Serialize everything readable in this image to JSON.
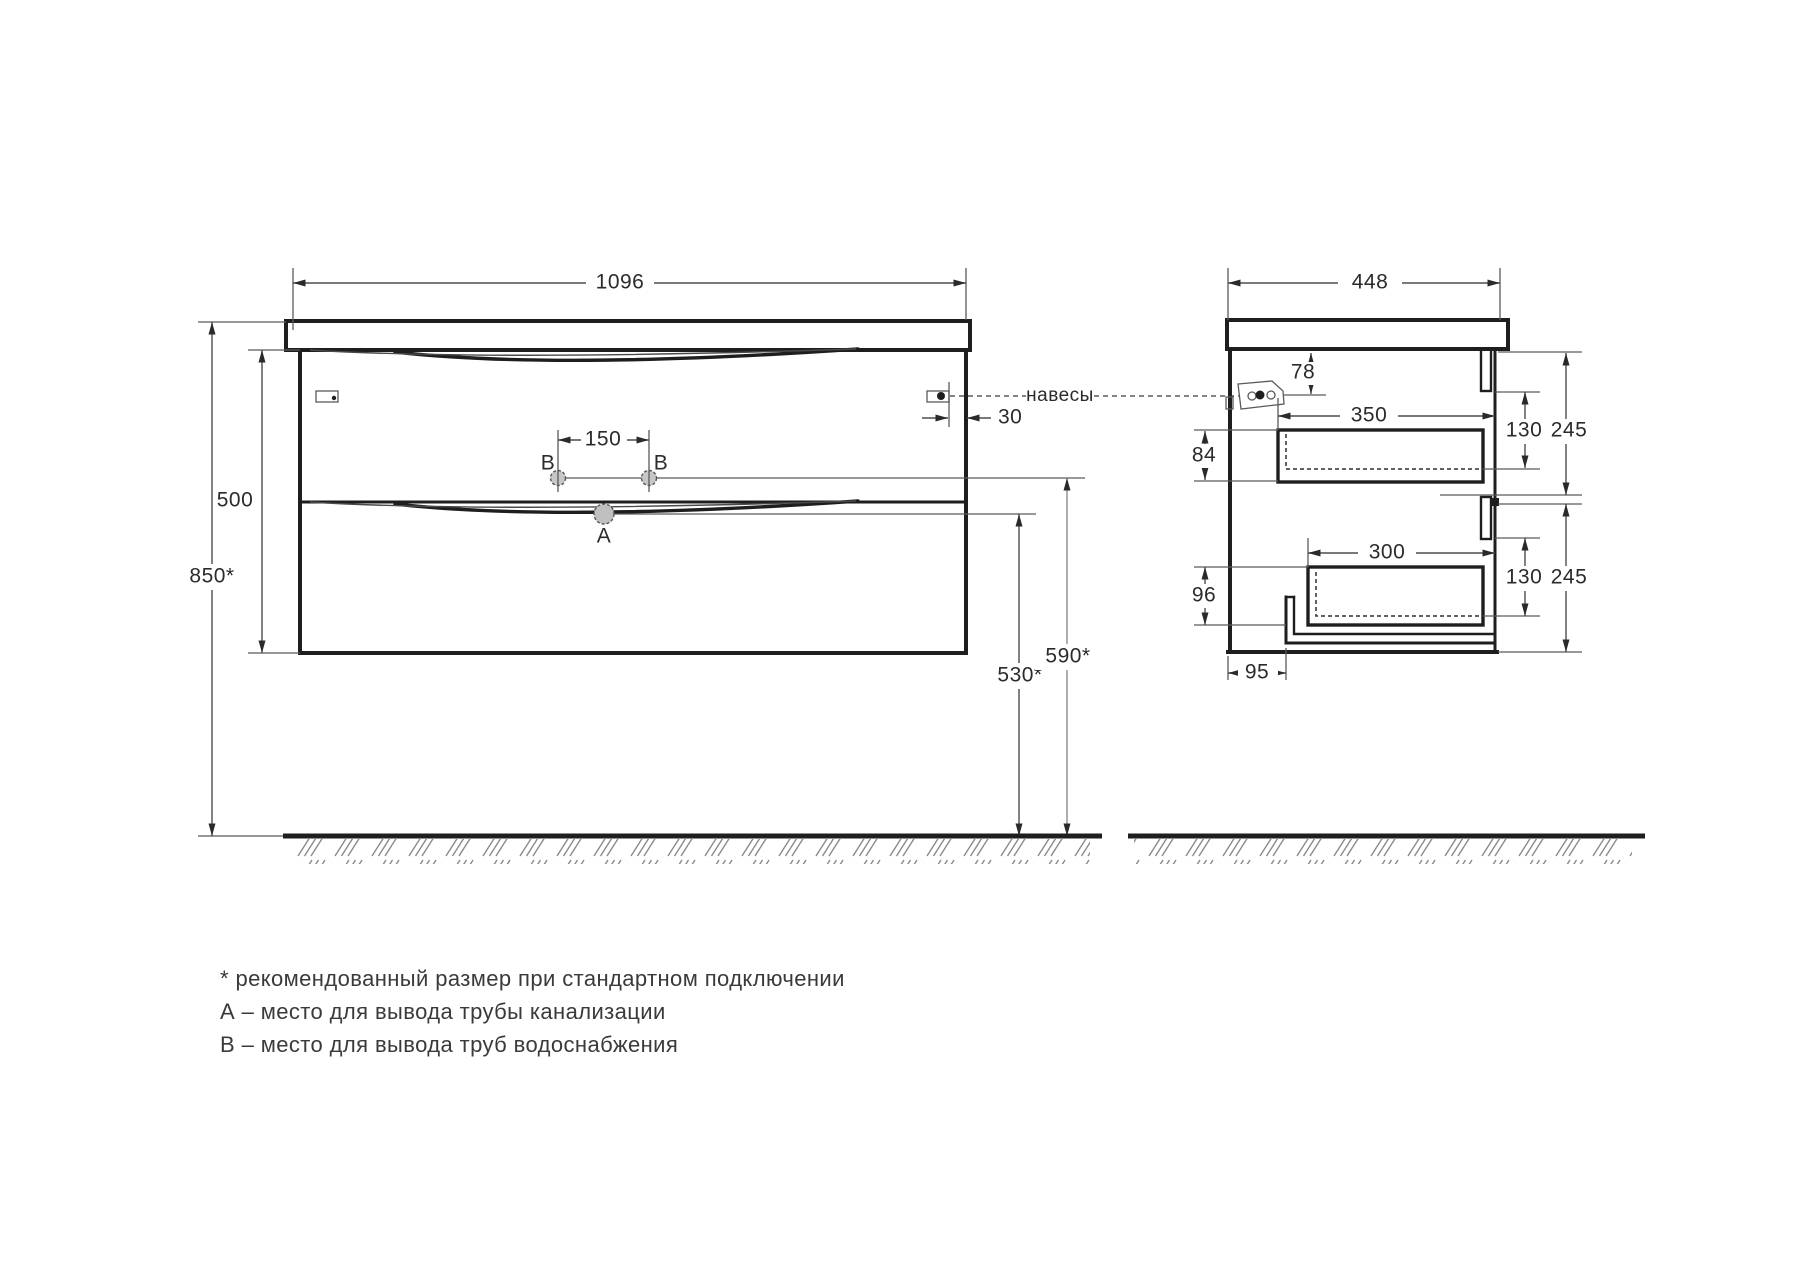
{
  "drawing": {
    "front_view": {
      "width_mm": "1096",
      "cabinet_height_mm": "500",
      "install_height_mm": "850*",
      "water_outlets_spacing_mm": "150",
      "hinge_inset_mm": "30",
      "drain_outlet_height_mm": "530*",
      "water_outlet_height_mm": "590*",
      "label_drain": "A",
      "label_water_left": "B",
      "label_water_right": "B",
      "hinges_label": "навесы"
    },
    "side_view": {
      "depth_mm": "448",
      "hinge_from_top_mm": "78",
      "top_drawer_inner_length_mm": "350",
      "top_drawer_inner_depth_mm": "130",
      "top_drawer_front_mm": "245",
      "top_drawer_back_offset_mm": "84",
      "bottom_drawer_inner_length_mm": "300",
      "bottom_drawer_inner_depth_mm": "130",
      "bottom_drawer_front_mm": "245",
      "bottom_drawer_back_offset_mm": "96",
      "pipe_channel_offset_mm": "95"
    },
    "legend": {
      "note_asterisk": "* рекомендованный размер при стандартном подключении",
      "note_a": "А – место для вывода трубы канализации",
      "note_b": "В – место для вывода труб водоснабжения"
    },
    "colors": {
      "line": "#1e1e1e",
      "thin_line": "#5a5a5a",
      "background": "#ffffff"
    }
  }
}
